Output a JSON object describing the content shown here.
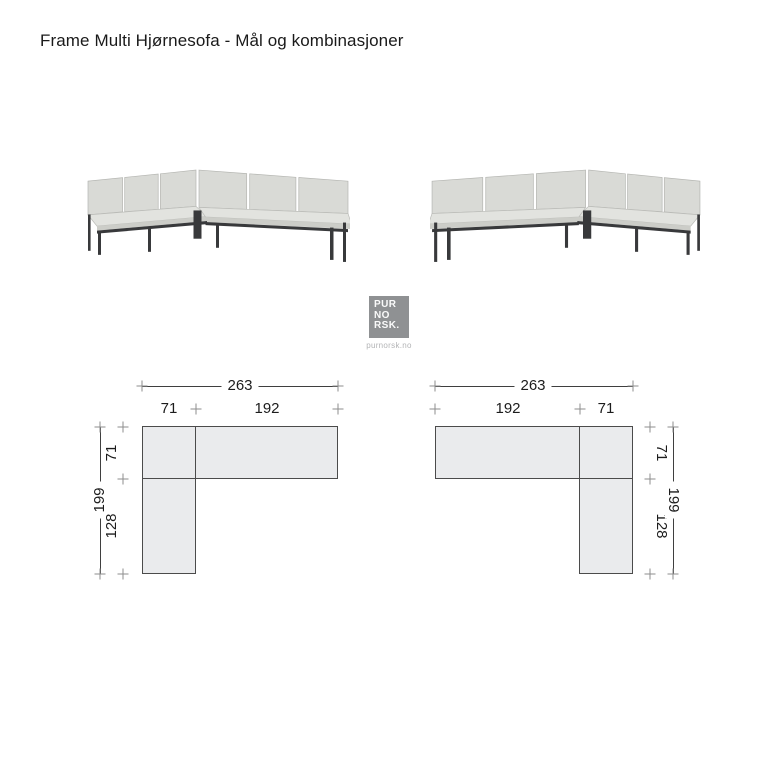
{
  "header": {
    "title": "Frame Multi Hjørnesofa - Mål og kombinasjoner"
  },
  "logo": {
    "lines": [
      "PUR",
      "NO",
      "RSK."
    ],
    "url": "purnorsk.no"
  },
  "icons": {
    "sofa_left": "corner-sofa-render-left-orientation",
    "sofa_right": "corner-sofa-render-right-orientation",
    "logo_mark": "purnorsk-gray-square-logo"
  },
  "colors": {
    "text": "#1a1a1a",
    "diagram_fill": "#eaebed",
    "diagram_border": "#4b4b4b",
    "dim_line": "#3f3f3f",
    "dim_tick": "#8d8d8d",
    "cushion": "#d9dad6",
    "frame": "#38393b",
    "logo_bg": "#8f9193"
  },
  "diagrams": {
    "left": {
      "total_width": "263",
      "segment_a": "71",
      "segment_b": "192",
      "side_upper": "71",
      "side_lower": "128",
      "total_height": "199"
    },
    "right": {
      "total_width": "263",
      "segment_a": "192",
      "segment_b": "71",
      "side_upper": "71",
      "side_lower": "128",
      "total_height": "199"
    }
  }
}
